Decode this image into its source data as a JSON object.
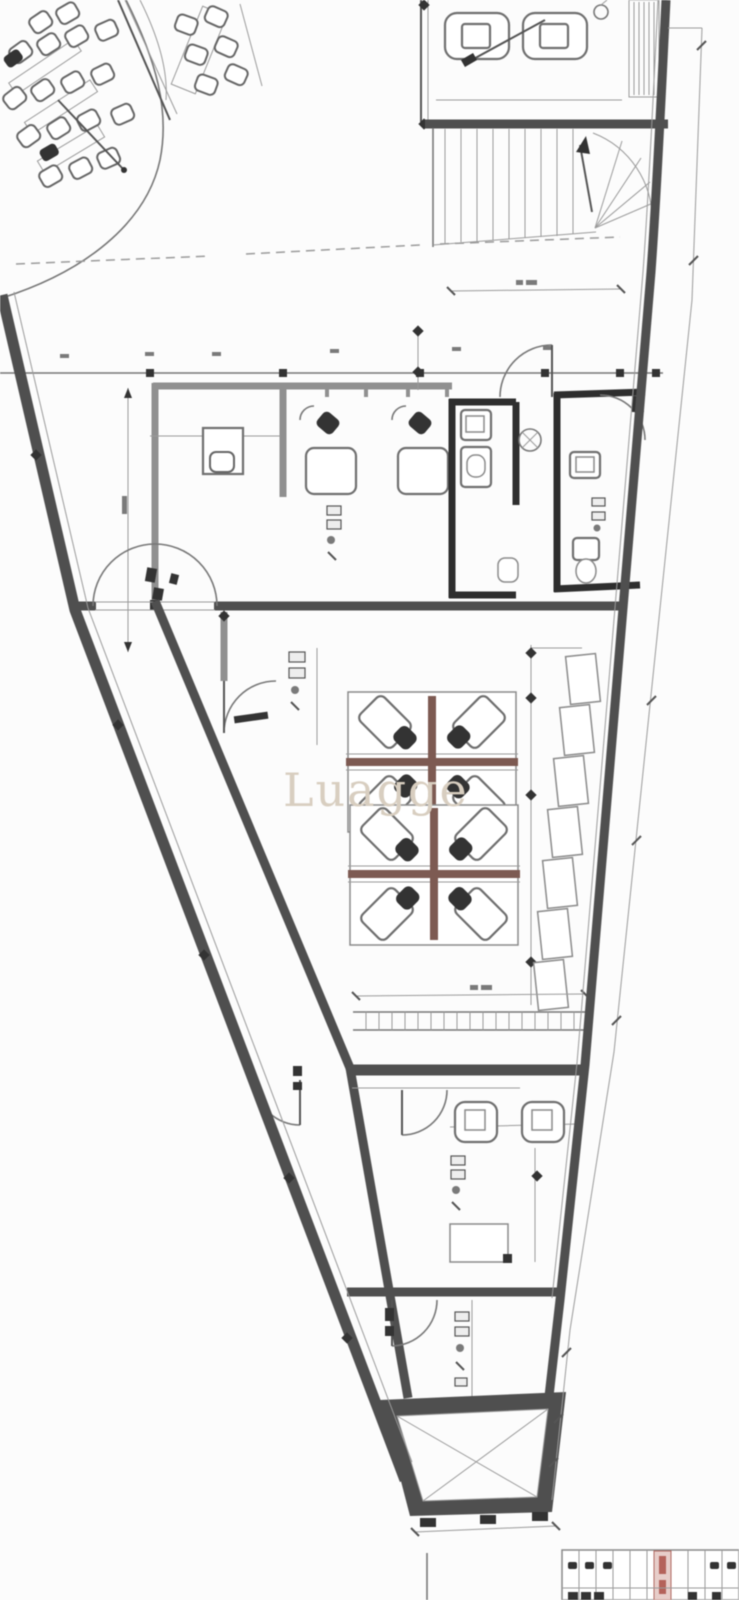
{
  "watermark": {
    "text": "Luagge"
  },
  "plan": {
    "type": "architectural-floor-plan",
    "building_shape": "triangular wedge narrowing toward bottom",
    "regions": [
      "reception-area",
      "top-right-office",
      "staircase",
      "middle-band-offices",
      "restrooms",
      "open-office",
      "workstation-cluster-1",
      "workstation-cluster-2",
      "side-cabinets",
      "lower-office",
      "bottom-room",
      "elevator-shaft",
      "sheet-fragment-table"
    ]
  },
  "colors": {
    "paper": "#fcfcfc",
    "ink": "#333333",
    "wall": "#4f4f4f",
    "wall-gray": "#909090",
    "line": "#777777",
    "line-light": "#9a9a9a",
    "maroon": "#7d5a52",
    "table-red": "#b4625a",
    "table-pink": "#e7cdc9",
    "watermark": "#d8cec0"
  }
}
